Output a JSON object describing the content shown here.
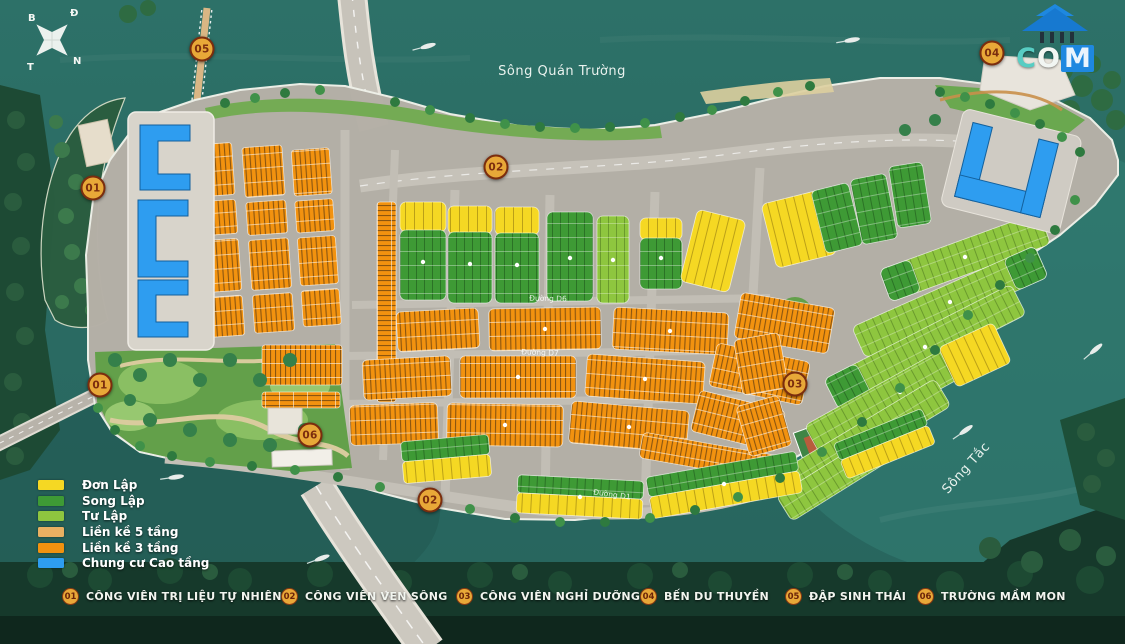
{
  "rivers": {
    "top": "Sông Quán Trường",
    "right": "Sông Tắc"
  },
  "compass": {
    "top_left": "B",
    "top_right": "Đ",
    "bottom_left": "T",
    "bottom_right": "N"
  },
  "logo": {
    "c": "C",
    "o": "O",
    "m": "M"
  },
  "roads": [
    "Đường D6",
    "Đường D7",
    "Đường D1"
  ],
  "legend": {
    "items": [
      {
        "label": "Đơn Lập",
        "color": "#f5d823"
      },
      {
        "label": "Song Lập",
        "color": "#3e9a35"
      },
      {
        "label": "Tư Lập",
        "color": "#8ec63f"
      },
      {
        "label": "Liền kề 5 tầng",
        "color": "#e9b062"
      },
      {
        "label": "Liền kề 3 tầng",
        "color": "#f2920f"
      },
      {
        "label": "Chung cư Cao tầng",
        "color": "#2e9df0"
      }
    ]
  },
  "locations": [
    {
      "num": "01",
      "label": "CÔNG VIÊN TRỊ LIỆU TỰ NHIÊN"
    },
    {
      "num": "02",
      "label": "CÔNG VIÊN VEN SÔNG"
    },
    {
      "num": "03",
      "label": "CÔNG VIÊN NGHỈ DƯỠNG"
    },
    {
      "num": "04",
      "label": "BẾN DU THUYỀN"
    },
    {
      "num": "05",
      "label": "ĐẬP SINH THÁI"
    },
    {
      "num": "06",
      "label": "TRƯỜNG MẦM MON"
    }
  ],
  "markers": [
    {
      "num": "05"
    },
    {
      "num": "04"
    },
    {
      "num": "02"
    },
    {
      "num": "01"
    },
    {
      "num": "01"
    },
    {
      "num": "03"
    },
    {
      "num": "06"
    },
    {
      "num": "02"
    }
  ],
  "marker_colors": {
    "bg": "#e8a838",
    "border": "#7b2d0e",
    "text": "#7b2d0e"
  }
}
